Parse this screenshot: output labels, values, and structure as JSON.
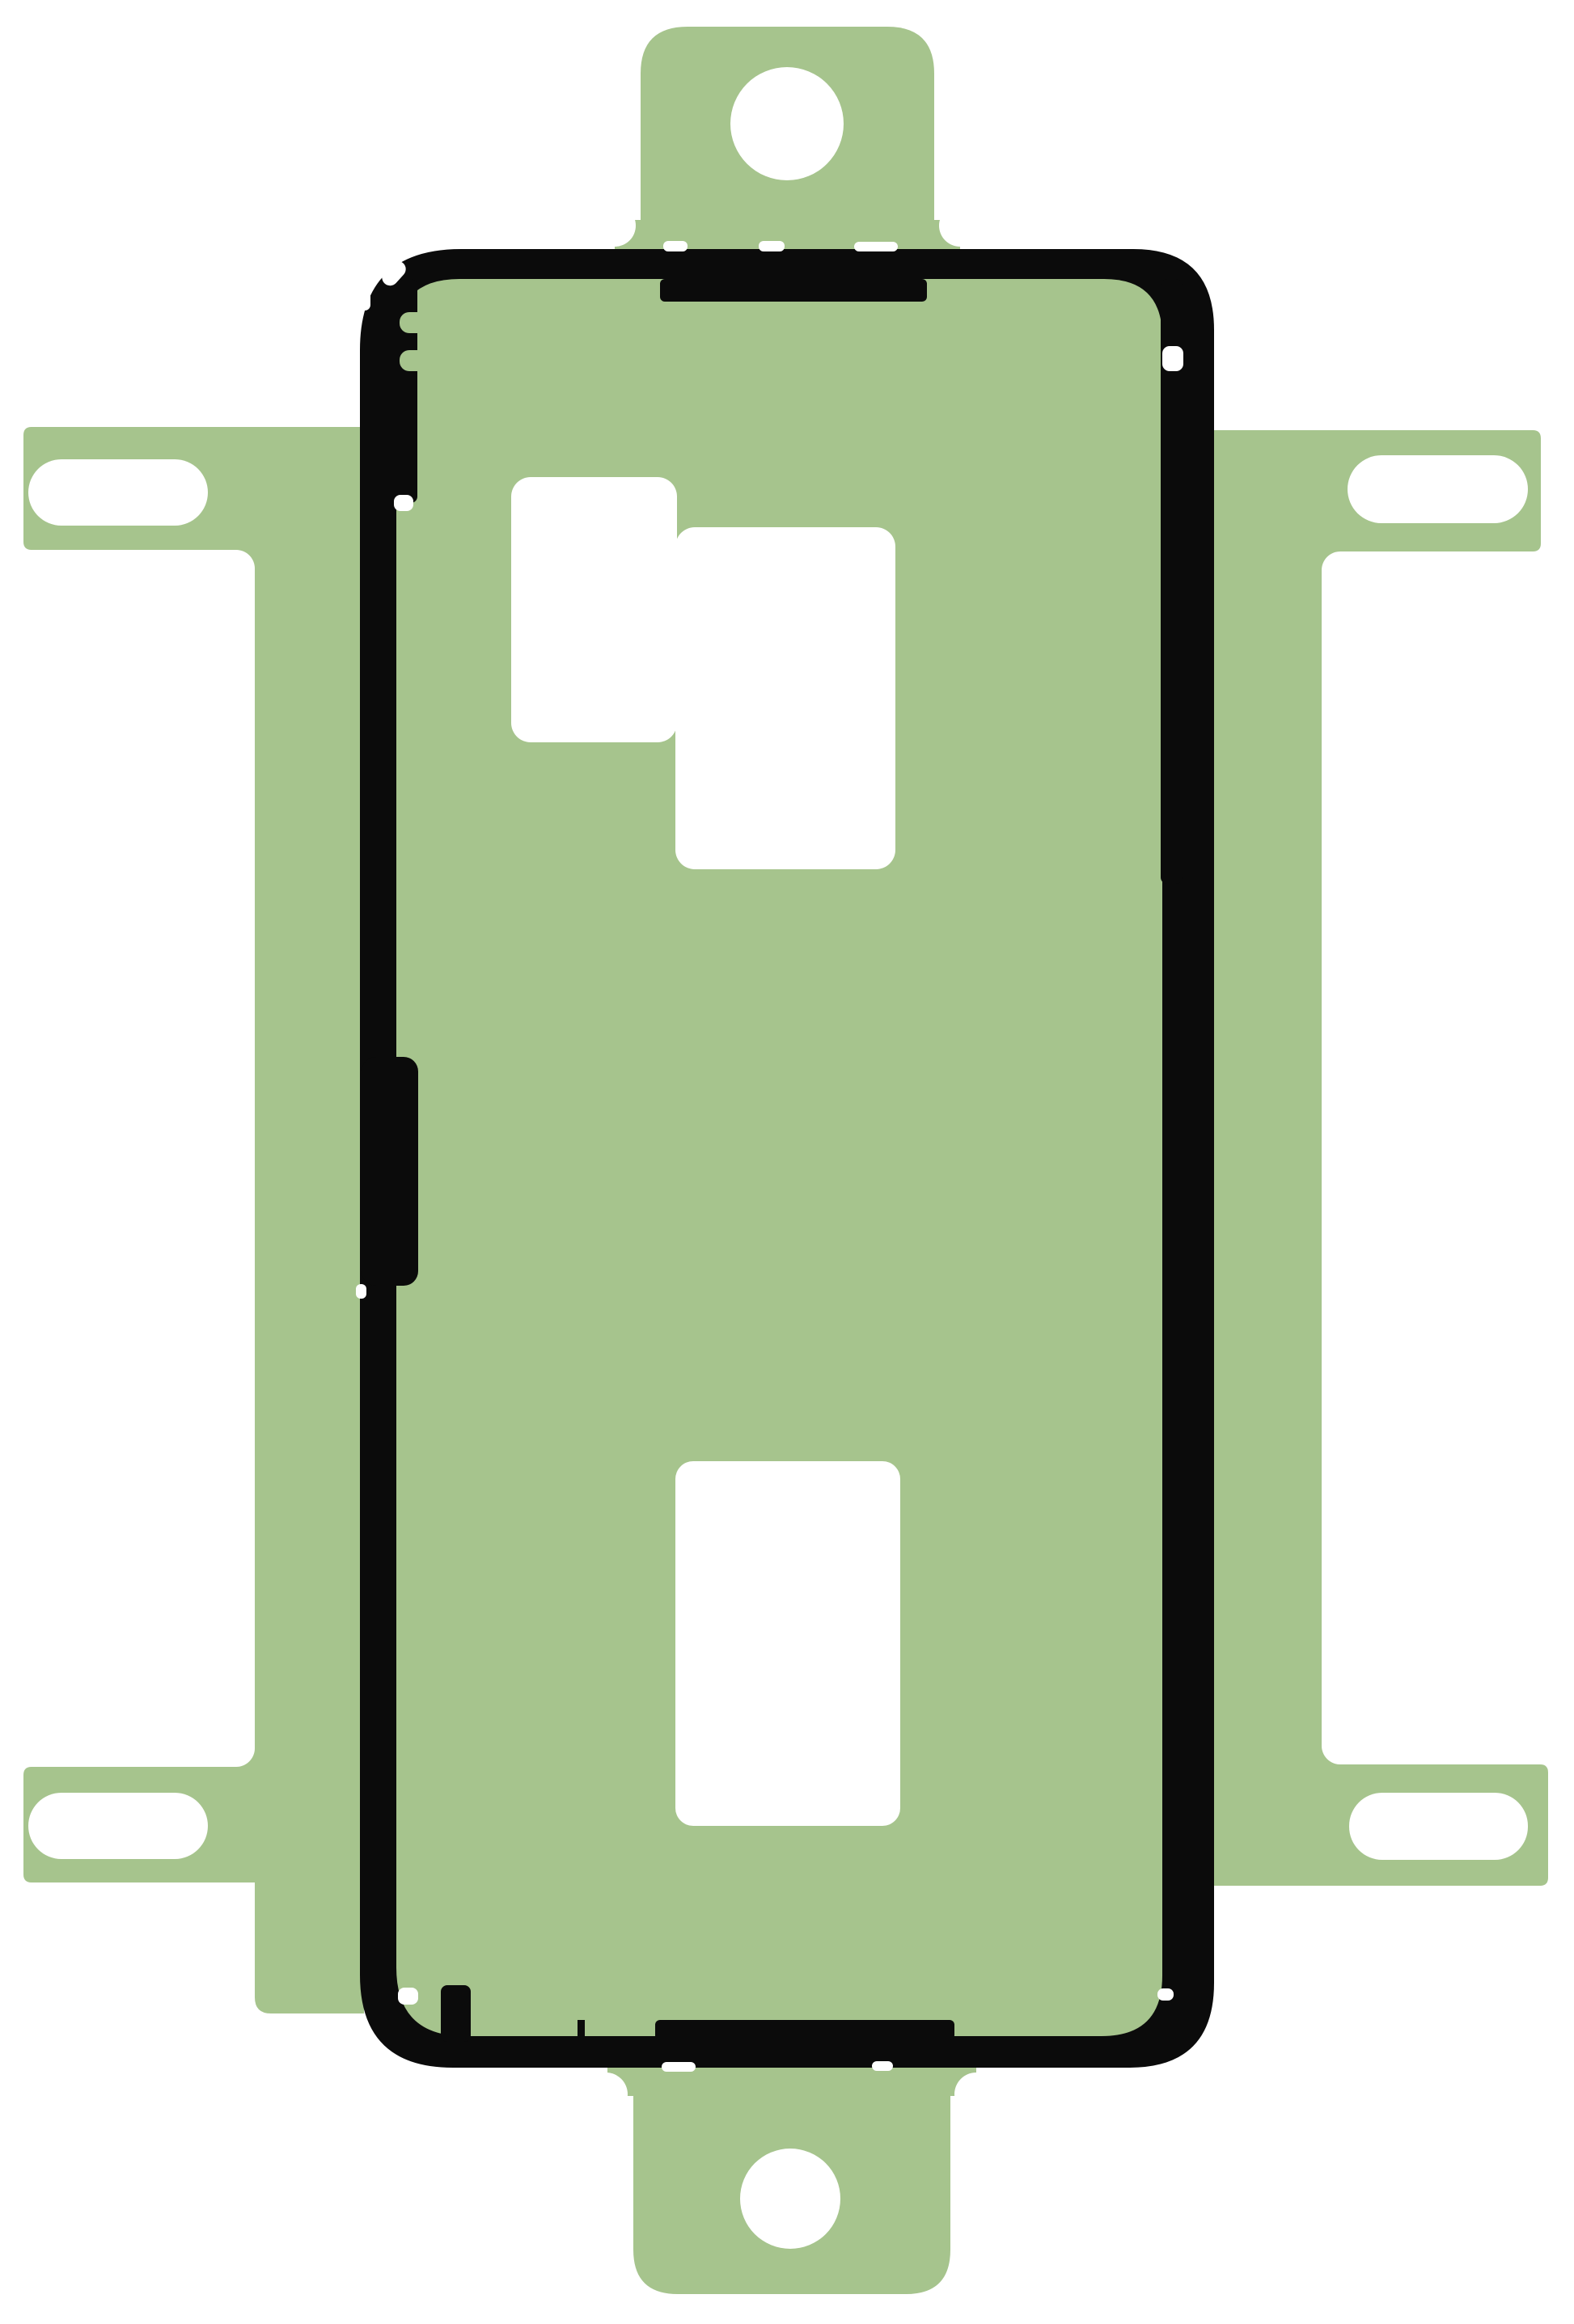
{
  "image": {
    "subject": "phone-back-cover-adhesive-sticker",
    "description": "Green adhesive gasket sheet with black sealing outline, alignment tabs and slots",
    "background_color": "#ffffff",
    "sheet_color": "#a6c48d",
    "gasket_color": "#0b0b0b",
    "parts": [
      {
        "name": "top-alignment-tab",
        "feature": "round-hole"
      },
      {
        "name": "bottom-alignment-tab",
        "feature": "round-hole"
      },
      {
        "name": "upper-left-arm",
        "feature": "slot-hole"
      },
      {
        "name": "lower-left-arm",
        "feature": "slot-hole"
      },
      {
        "name": "upper-right-arm",
        "feature": "slot-hole"
      },
      {
        "name": "lower-right-arm",
        "feature": "slot-hole"
      },
      {
        "name": "black-gasket-outline",
        "feature": "rounded-rectangle-seal"
      },
      {
        "name": "camera-cutout",
        "feature": "stepped-white-cutout"
      },
      {
        "name": "battery-cutout",
        "feature": "rectangular-white-cutout"
      }
    ]
  }
}
